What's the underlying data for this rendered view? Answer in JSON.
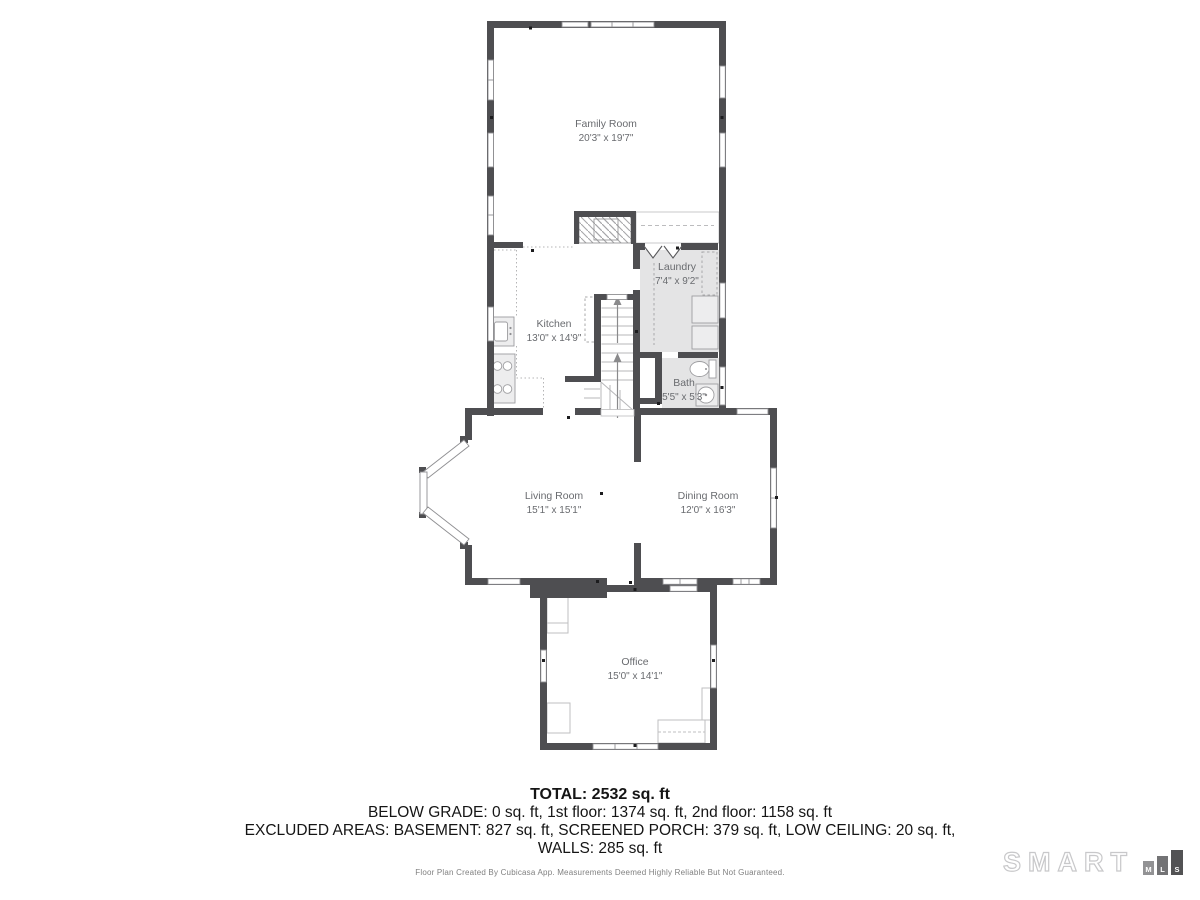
{
  "rooms": {
    "family": {
      "name": "Family Room",
      "dims": "20'3\" x 19'7\""
    },
    "laundry": {
      "name": "Laundry",
      "dims": "7'4\" x 9'2\""
    },
    "kitchen": {
      "name": "Kitchen",
      "dims": "13'0\" x 14'9\""
    },
    "bath": {
      "name": "Bath",
      "dims": "5'5\" x 5'3\""
    },
    "living": {
      "name": "Living Room",
      "dims": "15'1\" x 15'1\""
    },
    "dining": {
      "name": "Dining Room",
      "dims": "12'0\" x 16'3\""
    },
    "office": {
      "name": "Office",
      "dims": "15'0\" x 14'1\""
    }
  },
  "summary": {
    "total": "TOTAL: 2532 sq. ft",
    "below_grade": "BELOW GRADE: 0 sq. ft, 1st floor: 1374 sq. ft, 2nd floor: 1158 sq. ft",
    "excluded": "EXCLUDED AREAS: BASEMENT: 827 sq. ft, SCREENED PORCH: 379 sq. ft, LOW CEILING: 20 sq. ft,",
    "walls": "WALLS: 285 sq. ft",
    "disclaimer": "Floor Plan Created By Cubicasa App. Measurements Deemed Highly Reliable But Not Guaranteed."
  },
  "logo": {
    "brand": "SMART",
    "m": "M",
    "l": "L",
    "s": "S"
  },
  "colors": {
    "wall": "#4e4e51",
    "gray_floor": "#e4e4e5",
    "label": "#696b6f",
    "logo_outline": "#c8c8ca",
    "logo_m": "#929294",
    "logo_l": "#737375",
    "logo_s": "#525254"
  }
}
